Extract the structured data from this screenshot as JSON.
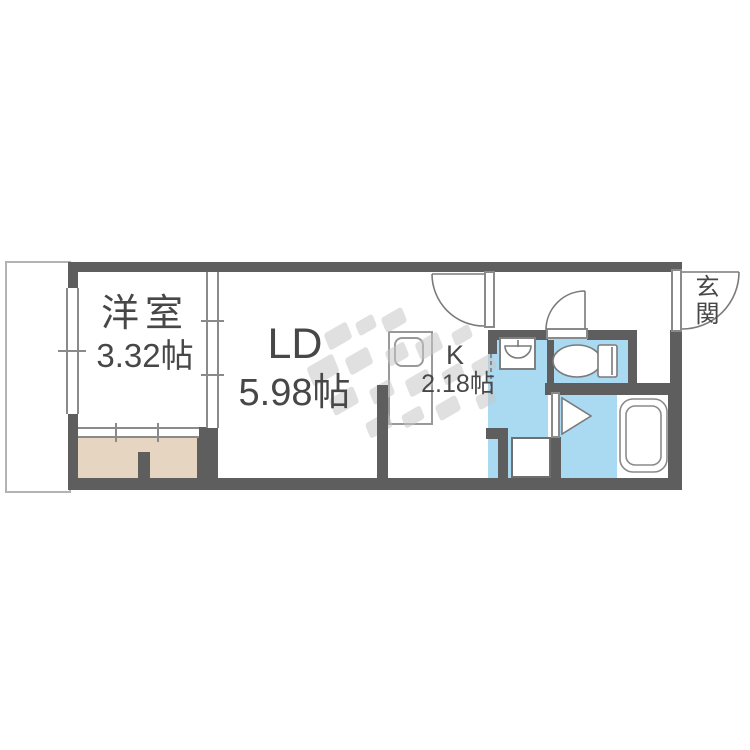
{
  "rooms": {
    "western": {
      "name": "洋室",
      "size": "3.32帖"
    },
    "living_dining": {
      "name": "LD",
      "size": "5.98帖"
    },
    "kitchen": {
      "name": "K",
      "size": "2.18帖"
    },
    "entrance": {
      "name": "玄関"
    }
  },
  "fixtures": {
    "kitchen_sink": "kitchen-sink-icon",
    "washbasin": "washbasin-icon",
    "toilet": "toilet-icon",
    "bathtub": "bathtub-icon",
    "washing_machine_pan": "washing-machine-pan",
    "door_swings": "door-swing-arc",
    "watermark": "agency-logo-watermark"
  },
  "colors": {
    "wall": "#5e5e5e",
    "wet_area": "#a9daf2",
    "balcony": "#e6d5c0",
    "fixture_line": "#7a7a7a",
    "text": "#474747",
    "watermark": "#c7c7c7",
    "window_line": "#8a8a8a"
  }
}
